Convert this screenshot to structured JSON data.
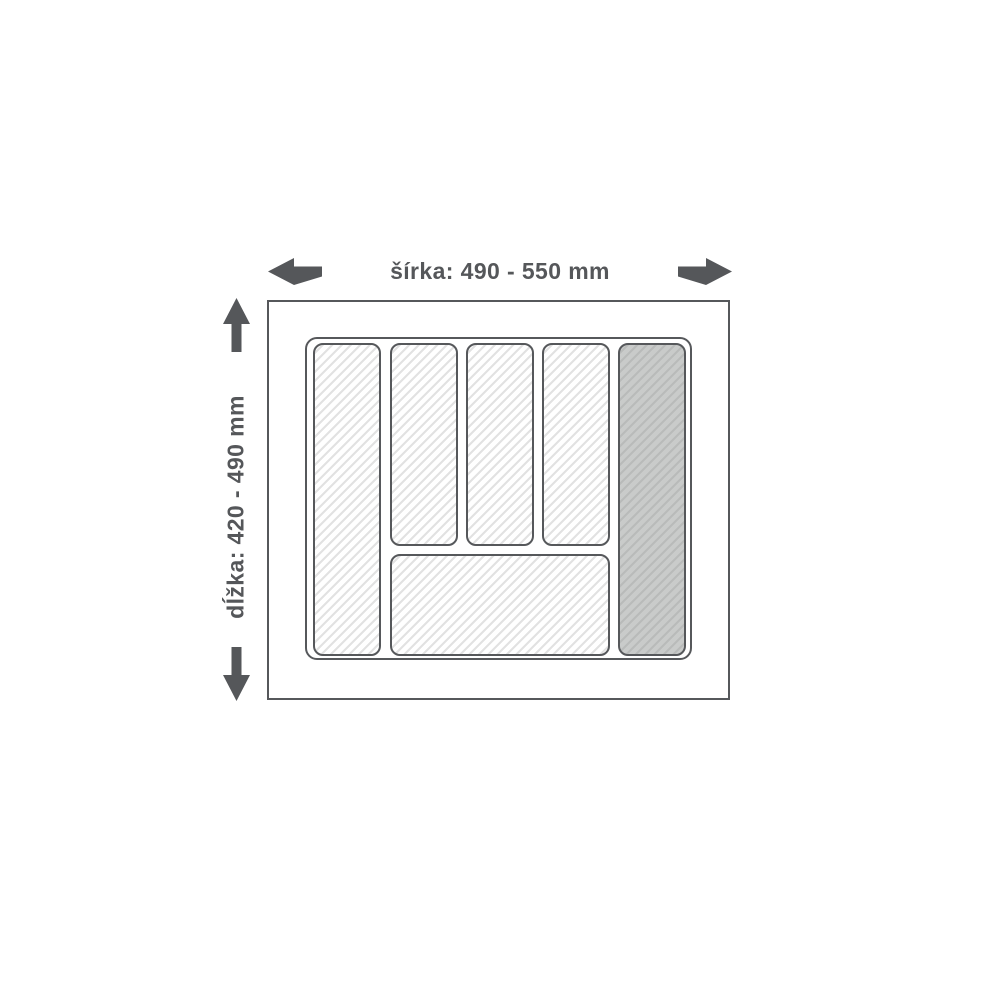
{
  "diagram": {
    "type": "cutlery-tray-dimension-diagram",
    "width_dimension": {
      "label": "šírka: 490 - 550 mm",
      "axis": "horizontal"
    },
    "length_dimension": {
      "label": "dĺžka: 420 - 490 mm",
      "axis": "vertical"
    },
    "compartments": [
      {
        "id": "left-tall",
        "shading": "light"
      },
      {
        "id": "top-middle-1",
        "shading": "light"
      },
      {
        "id": "top-middle-2",
        "shading": "light"
      },
      {
        "id": "top-middle-3",
        "shading": "light"
      },
      {
        "id": "bottom-wide",
        "shading": "light"
      },
      {
        "id": "right-tall",
        "shading": "dark"
      }
    ],
    "colors": {
      "outline": "#56585b",
      "text": "#55575a",
      "arrow": "#55575a",
      "hatch_light_bg": "#ffffff",
      "hatch_light_stripe": "#e2e2e2",
      "hatch_dark_bg": "#c9cbca",
      "hatch_dark_stripe": "#b9bbba"
    }
  }
}
